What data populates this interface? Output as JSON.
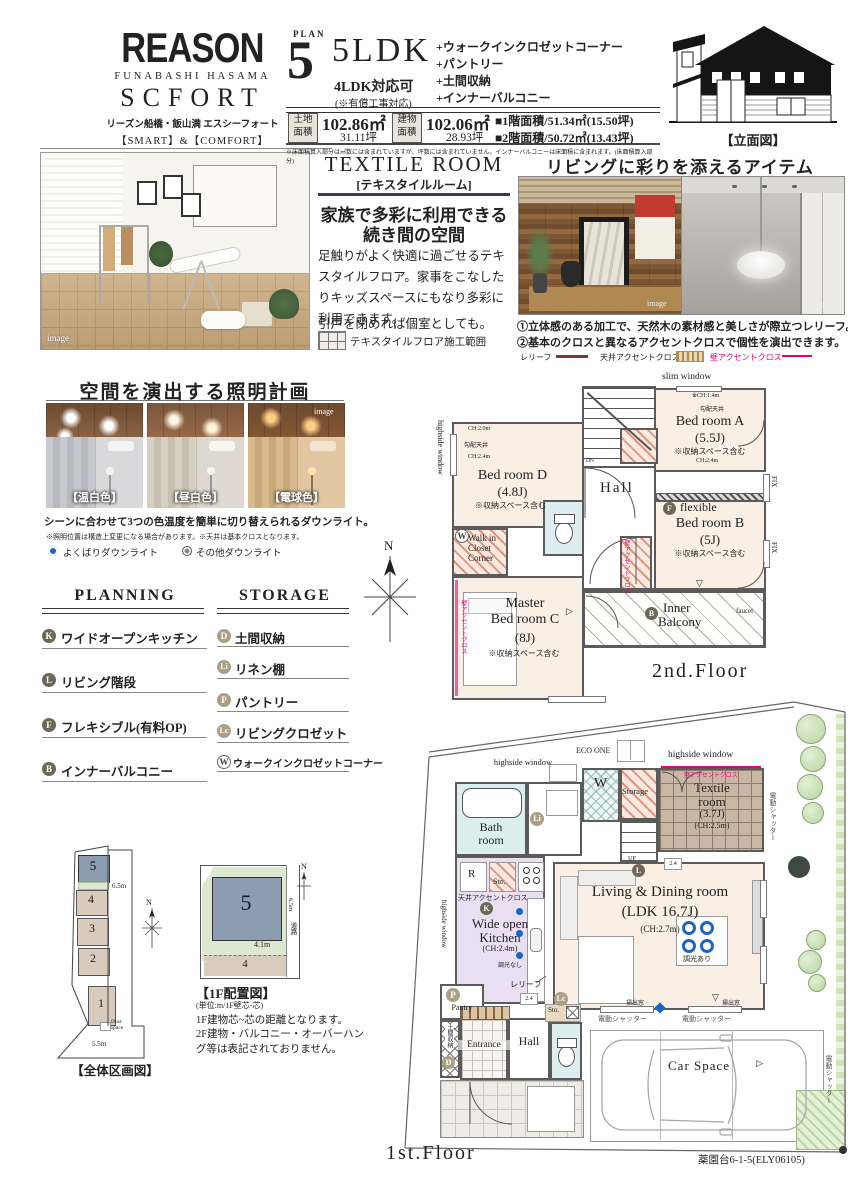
{
  "compass": {
    "n": "N"
  },
  "logo": {
    "brand": "REASON",
    "area": "FUNABASHI HASAMA",
    "name": "SCFORT",
    "kana": "リーズン船橋・飯山満 エスシーフォート",
    "tagline": "【SMART】&【COMFORT】"
  },
  "plan": {
    "plan_word": "PLAN",
    "number": "5",
    "type": "5LDK",
    "alt": "4LDK対応可",
    "alt_note": "(※有償工事対応)",
    "features": [
      "+ウォークインクロゼットコーナー",
      "+パントリー",
      "+土間収納",
      "+インナーバルコニー"
    ],
    "land_label1": "土地",
    "land_label2": "面積",
    "land_m2": "102.86㎡",
    "land_tsubo": "31.11坪",
    "bldg_label1": "建物",
    "bldg_label2": "面積",
    "bldg_m2": "102.06㎡",
    "bldg_tsubo": "28.93坪",
    "f1_area": "■1階面積/51.34㎡(15.50坪)",
    "f2_area": "■2階面積/50.72㎡(13.43坪)",
    "fine": "※床面積算入部分は㎡数には含まれていますが、坪数には含まれていません。インナーバルコニーは床面積に含まれます。(床面積算入部分)"
  },
  "elevation": {
    "caption": "【立面図】"
  },
  "textile": {
    "title": "TEXTILE ROOM",
    "sub": "[テキスタイルルーム]",
    "h1": "家族で多彩に利用できる",
    "h2": "続き間の空間",
    "p1": "足触りがよく快適に過ごせるテキスタイルフロア。家事をこなしたりキッズスペースにもなり多彩に利用できます。",
    "p2": "引戸を閉めれば個室としても。",
    "legend": "テキスタイルフロア施工範囲",
    "img": "image"
  },
  "items": {
    "title": "リビングに彩りを添えるアイテム",
    "c1": "①立体感のある加工で、天然木の素材感と美しさが際立つレリーフ。",
    "c2": "②基本のクロスと異なるアクセントクロスで個性を演出できます。",
    "lg1": "レリーフ",
    "lg2": "天井アクセントクロス",
    "lg3": "壁アクセントクロス",
    "img": "image"
  },
  "light": {
    "title": "空間を演出する照明計画",
    "l1": "【温白色】",
    "l2": "【昼白色】",
    "l3": "【電球色】",
    "cap": "シーンに合わせて3つの色温度を簡単に切り替えられるダウンライト。",
    "note": "※照明位置は構造上変更になる場合があります。※天井は基本クロスとなります。",
    "lg1": "よくばりダウンライト",
    "lg2": "その他ダウンライト",
    "img": "image"
  },
  "legend": {
    "planning_title": "PLANNING",
    "storage_title": "STORAGE",
    "planning": [
      {
        "k": "K",
        "t": "ワイドオープンキッチン"
      },
      {
        "k": "L",
        "t": "リビング階段"
      },
      {
        "k": "F",
        "t": "フレキシブル(有料OP)"
      },
      {
        "k": "B",
        "t": "インナーバルコニー"
      }
    ],
    "storage": [
      {
        "k": "D",
        "t": "土間収納"
      },
      {
        "k": "Li",
        "t": "リネン棚"
      },
      {
        "k": "P",
        "t": "パントリー"
      },
      {
        "k": "Lc",
        "t": "リビングクロゼット"
      },
      {
        "k": "W",
        "t": "ウォークインクロゼットコーナー"
      }
    ]
  },
  "f2": {
    "floor": "2nd.Floor",
    "slim": "slim window",
    "highside": "highside window",
    "bedA1": "Bed room A",
    "bedA2": "(5.5J)",
    "bedB1": "Bed room B",
    "bedB2": "(5J)",
    "bedD1": "Bed room D",
    "bedD2": "(4.8J)",
    "mc1": "Master",
    "mc2": "Bed room C",
    "mc3": "(8J)",
    "storage_note": "※収納スペース含む",
    "hall": "Hall",
    "dn": "DN",
    "flex": "flexible",
    "wic1": "Walk in",
    "wic2": "Closet",
    "wic3": "Corner",
    "bal1": "Inner",
    "bal2": "Balcony",
    "faucet": "faucet",
    "fix": "FIX",
    "ch14": "※CH:1.4m",
    "ch20": "CH:2.0m",
    "ch24": "CH:2.4m",
    "slope": "勾配天井",
    "accent": "壁アクセントクロス"
  },
  "f1": {
    "floor": "1st.Floor",
    "eco": "ECO ONE",
    "highside": "highside window",
    "bath1": "Bath",
    "bath2": "room",
    "w": "W",
    "storage": "Storage",
    "tex1": "Textile",
    "tex2": "room",
    "tex3": "(3.7J)",
    "tex4": "(CH:2.5m)",
    "kitchen1": "Wide open",
    "kitchen2": "Kitchen",
    "kitchen3": "(CH:2.4m)",
    "ceil_accent": "天井アクセントクロス",
    "wall_accent": "壁アクセントクロス",
    "ldk1": "Living & Dining room",
    "ldk2": "(LDK 16.7J)",
    "ldk3": "(CH:2.7m)",
    "relief": "レリーフ",
    "r": "R",
    "sto": "Sto.",
    "pantry": "Pantry",
    "doma": "土間収納",
    "entrance": "Entrance",
    "hall": "Hall",
    "up": "UP",
    "dim_yes": "調光あり",
    "dim_no": "調光なし",
    "shutter": "電動シャッター",
    "car": "Car Space",
    "sweep": "掃出窓",
    "v24": "2.4"
  },
  "site": {
    "caption": "【全体区画図】",
    "road_w": "6.5m",
    "bottom_w": "5.5m",
    "dust1": "Dust",
    "dust2": "space",
    "lots": [
      "5",
      "4",
      "3",
      "2",
      "1"
    ]
  },
  "plc": {
    "caption": "【1F配置図】",
    "unit": "(単位:m/1F壁芯-芯)",
    "note1": "1F建物芯~芯の距離となります。",
    "note2": "2F建物・バルコニー・オーバーハング等は表記されておりません。",
    "lot5": "5",
    "lot4": "4",
    "dim": "4.1m",
    "road1": "6.5m",
    "road2": "道路"
  },
  "footer": {
    "code": "薬園台6-1-5(ELY06105)"
  }
}
